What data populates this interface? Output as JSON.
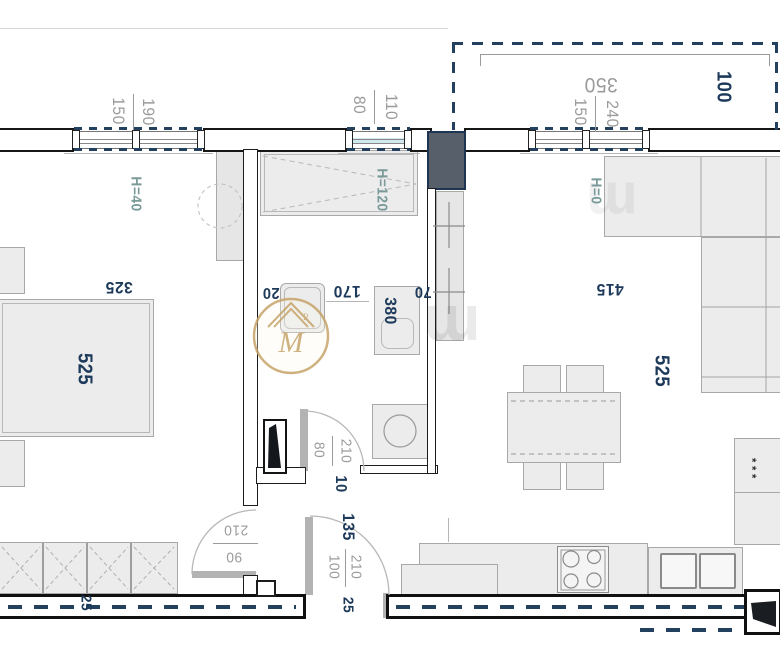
{
  "plan_type": "apartment floor plan (rotated 180°)",
  "colors": {
    "dim_navy": "#1d3a5a",
    "dim_gray": "#9b9b9b",
    "height_teal": "#7a9a9a",
    "wall_dash_navy": "#23405f",
    "shaft_fill": "#575f6b",
    "furniture_fill": "#ececec",
    "watermark_gold": "#c6a468"
  },
  "dims": [
    {
      "text": "150",
      "kind": "window-dim"
    },
    {
      "text": "190",
      "kind": "window-dim"
    },
    {
      "text": "80",
      "kind": "window-dim"
    },
    {
      "text": "110",
      "kind": "window-dim"
    },
    {
      "text": "350",
      "kind": "balcony-dim"
    },
    {
      "text": "150",
      "kind": "window-dim"
    },
    {
      "text": "240",
      "kind": "window-dim"
    },
    {
      "text": "100",
      "kind": "balcony-dim"
    },
    {
      "text": "H=40",
      "kind": "ceiling-height"
    },
    {
      "text": "H=120",
      "kind": "ceiling-height"
    },
    {
      "text": "H=0",
      "kind": "ceiling-height"
    },
    {
      "text": "325",
      "kind": "room-dim"
    },
    {
      "text": "525",
      "kind": "room-dim"
    },
    {
      "text": "20",
      "kind": "wall-dim"
    },
    {
      "text": "170",
      "kind": "room-dim"
    },
    {
      "text": "380",
      "kind": "room-dim"
    },
    {
      "text": "70",
      "kind": "room-dim"
    },
    {
      "text": "415",
      "kind": "room-dim"
    },
    {
      "text": "525",
      "kind": "room-dim"
    },
    {
      "text": "80",
      "kind": "door-dim"
    },
    {
      "text": "210",
      "kind": "door-dim"
    },
    {
      "text": "10",
      "kind": "wall-dim"
    },
    {
      "text": "210",
      "kind": "door-dim"
    },
    {
      "text": "90",
      "kind": "door-dim"
    },
    {
      "text": "135",
      "kind": "room-dim"
    },
    {
      "text": "100",
      "kind": "door-dim"
    },
    {
      "text": "210",
      "kind": "door-dim"
    },
    {
      "text": "25",
      "kind": "wall-dim"
    },
    {
      "text": "25",
      "kind": "wall-dim"
    },
    {
      "text": "***",
      "kind": "freezer-stars"
    }
  ],
  "watermark": {
    "logo_letter": "M",
    "registered_mark": "R",
    "faint_letter": "m"
  }
}
